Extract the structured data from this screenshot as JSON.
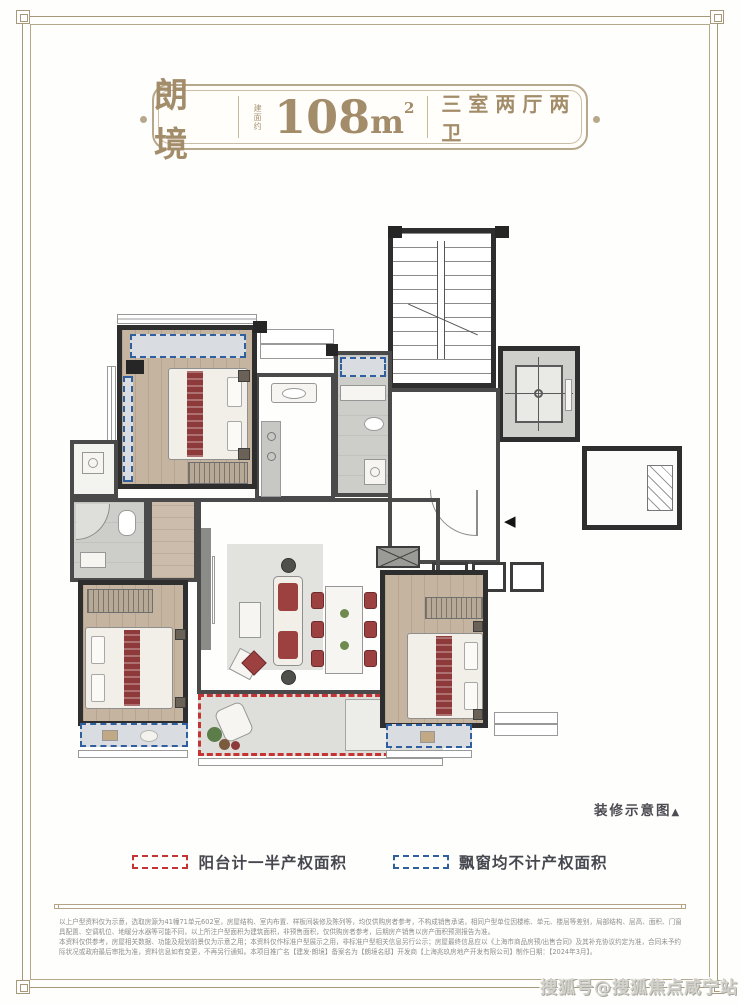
{
  "header": {
    "project_name": "朗境",
    "area_prefix": "建面约",
    "area_value": "108",
    "area_unit_base": "m",
    "area_unit_sup": "2",
    "layout_label": "三室两厅两卫",
    "accent_color": "#a38c69"
  },
  "plan": {
    "caption": "装修示意图",
    "caption_arrow": "▲",
    "entry_marker": "◀",
    "wall_color": "#2e2e2e",
    "bay_window_color": "#2f5f9e",
    "balcony_color": "#c53434"
  },
  "legend": {
    "balcony": {
      "label": "阳台计一半产权面积",
      "color": "#c53434"
    },
    "baywindow": {
      "label": "飘窗均不计产权面积",
      "color": "#2f5f9e"
    }
  },
  "disclaimer": {
    "lines": [
      "以上户型资料仅为示意，选取房源为41幢71单元602室，房屋结构、室内布置、样板间装修及陈列等，均仅供购房者参考，不构成销售承诺，相同户型单位因楼栋、单元、楼层等差别，局部结构、层高、面积、门窗、室内装修示意、家",
      "具配置、空调机位、地暖分水器等可能不同，以上所注户型面积为建筑面积，非预售面积，仅供购房者参考，后期房产销售以房产面积预测报告为准。",
      "本资料仅供参考，房屋相关数据、功能及规划前景仅为示意之用；本资料仅作标准户型展示之用，非标准户型相关信息另行公示；房屋最终信息应以《上海市商品房预/出售合同》及其补充协议约定为准，合同未予约定的，则以房屋最终实",
      "际状况或政府最后审批为准，资料信息如有变更，不再另行通知。本项目推广名【建发·朗境】备案名为【朗境名邸】开发商【上海兆玖房地产开发有限公司】制作日期：【2024年3月】。"
    ]
  },
  "watermark": {
    "text": "搜狐号@搜狐焦点咸宁站"
  }
}
